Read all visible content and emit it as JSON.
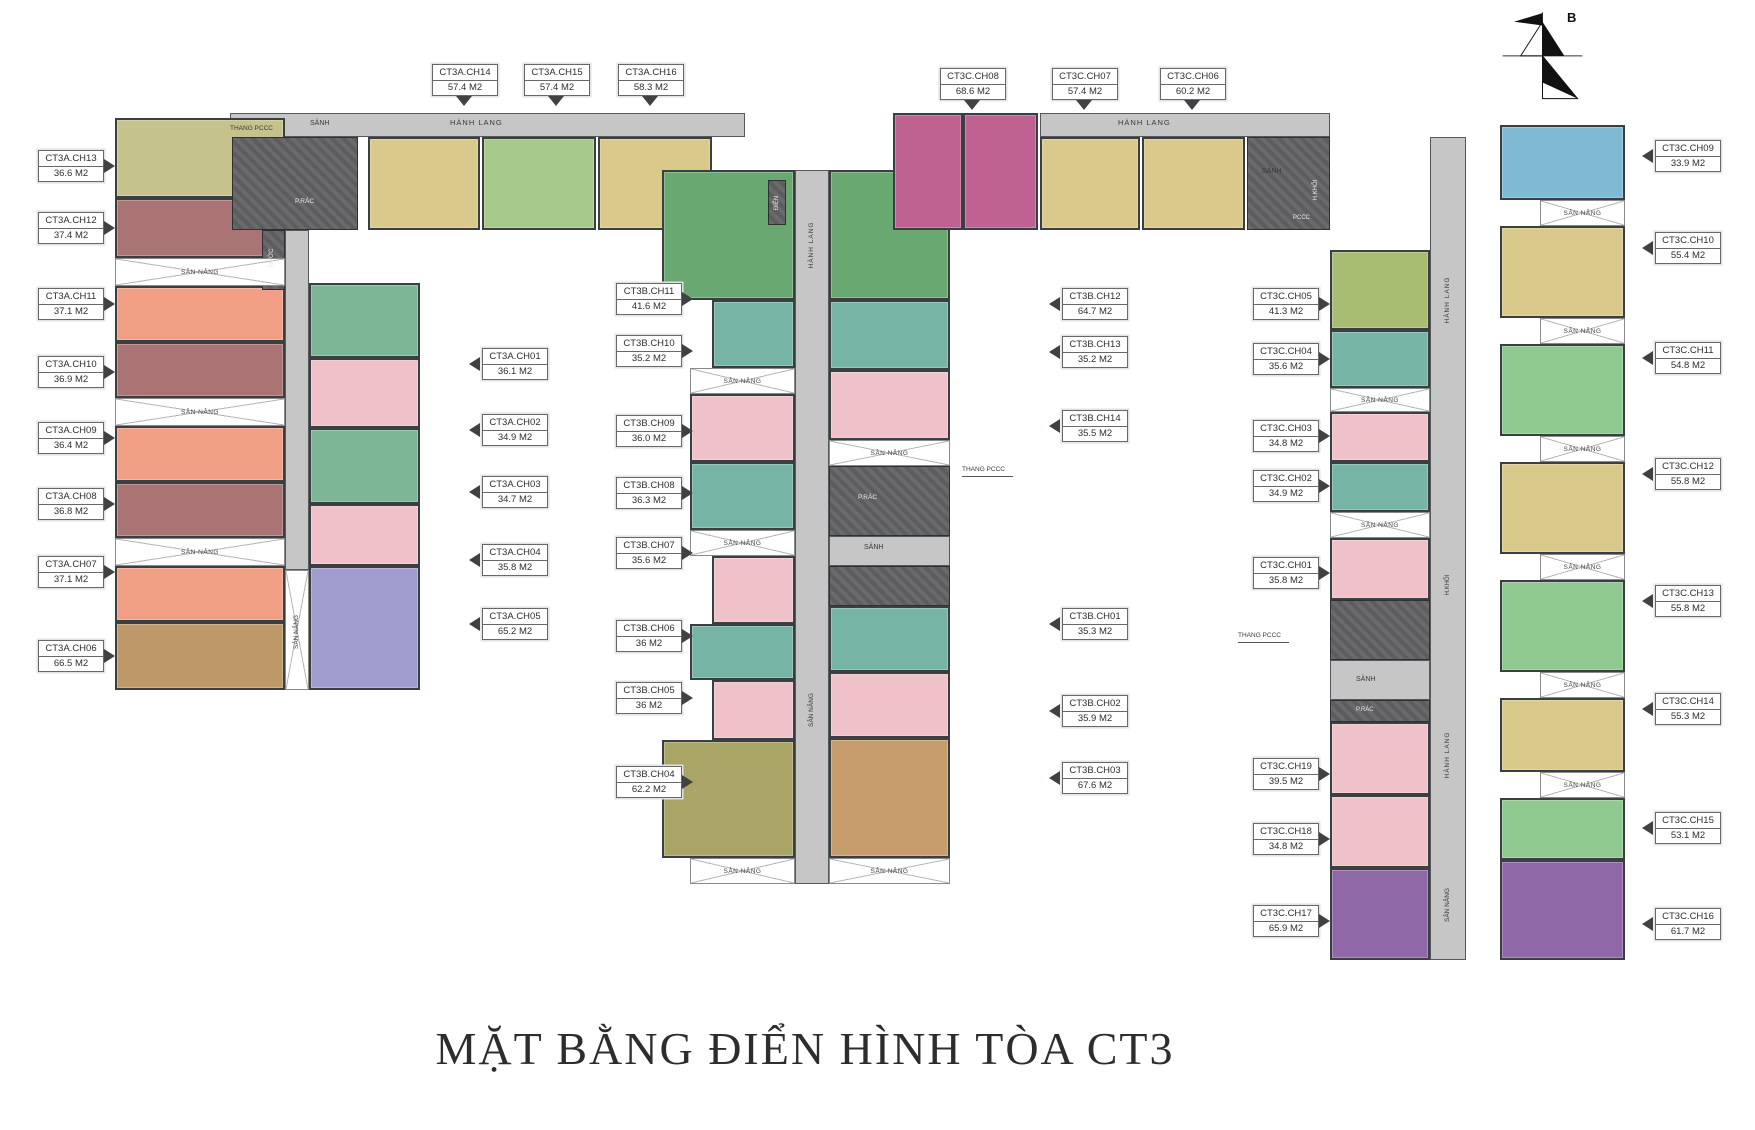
{
  "title": "MẶT BẰNG ĐIỂN HÌNH TÒA CT3",
  "compass_label": "B",
  "sn_label": "SÂN NÂNG",
  "units": [
    {
      "name": "CT3A.CH13",
      "area": "36.6 M2",
      "label": {
        "x": 38,
        "y": 150,
        "arrow": "right"
      },
      "block": {
        "x": 115,
        "y": 118,
        "w": 170,
        "h": 80,
        "color": "#c6c28b"
      }
    },
    {
      "name": "CT3A.CH12",
      "area": "37.4 M2",
      "label": {
        "x": 38,
        "y": 212,
        "arrow": "right"
      },
      "block": {
        "x": 115,
        "y": 198,
        "w": 170,
        "h": 60,
        "color": "#aa7474"
      }
    },
    {
      "name": "CT3A.CH11",
      "area": "37.1 M2",
      "label": {
        "x": 38,
        "y": 288,
        "arrow": "right"
      },
      "block": {
        "x": 115,
        "y": 286,
        "w": 170,
        "h": 56,
        "color": "#f19f85"
      }
    },
    {
      "name": "CT3A.CH10",
      "area": "36.9 M2",
      "label": {
        "x": 38,
        "y": 356,
        "arrow": "right"
      },
      "block": {
        "x": 115,
        "y": 342,
        "w": 170,
        "h": 56,
        "color": "#aa7474"
      }
    },
    {
      "name": "CT3A.CH09",
      "area": "36.4 M2",
      "label": {
        "x": 38,
        "y": 422,
        "arrow": "right"
      },
      "block": {
        "x": 115,
        "y": 426,
        "w": 170,
        "h": 56,
        "color": "#f19f85"
      }
    },
    {
      "name": "CT3A.CH08",
      "area": "36.8 M2",
      "label": {
        "x": 38,
        "y": 488,
        "arrow": "right"
      },
      "block": {
        "x": 115,
        "y": 482,
        "w": 170,
        "h": 56,
        "color": "#aa7474"
      }
    },
    {
      "name": "CT3A.CH07",
      "area": "37.1 M2",
      "label": {
        "x": 38,
        "y": 556,
        "arrow": "right"
      },
      "block": {
        "x": 115,
        "y": 566,
        "w": 170,
        "h": 56,
        "color": "#f19f85"
      }
    },
    {
      "name": "CT3A.CH06",
      "area": "66.5 M2",
      "label": {
        "x": 38,
        "y": 640,
        "arrow": "right"
      },
      "block": {
        "x": 115,
        "y": 622,
        "w": 170,
        "h": 68,
        "color": "#bf9869"
      }
    },
    {
      "name": "CT3A.CH14",
      "area": "57.4 M2",
      "label": {
        "x": 432,
        "y": 64,
        "arrow": "down"
      },
      "block": {
        "x": 368,
        "y": 137,
        "w": 112,
        "h": 93,
        "color": "#d9c98b"
      }
    },
    {
      "name": "CT3A.CH15",
      "area": "57.4 M2",
      "label": {
        "x": 524,
        "y": 64,
        "arrow": "down"
      },
      "block": {
        "x": 482,
        "y": 137,
        "w": 114,
        "h": 93,
        "color": "#a6c98c"
      }
    },
    {
      "name": "CT3A.CH16",
      "area": "58.3 M2",
      "label": {
        "x": 618,
        "y": 64,
        "arrow": "down"
      },
      "block": {
        "x": 598,
        "y": 137,
        "w": 114,
        "h": 93,
        "color": "#d9c98b"
      }
    },
    {
      "name": "CT3A.CH01",
      "area": "36.1 M2",
      "label": {
        "x": 482,
        "y": 348,
        "arrow": "left"
      },
      "block": {
        "x": 309,
        "y": 283,
        "w": 111,
        "h": 75,
        "color": "#7db696"
      }
    },
    {
      "name": "CT3A.CH02",
      "area": "34.9 M2",
      "label": {
        "x": 482,
        "y": 414,
        "arrow": "left"
      },
      "block": {
        "x": 309,
        "y": 358,
        "w": 111,
        "h": 70,
        "color": "#eec2c8"
      }
    },
    {
      "name": "CT3A.CH03",
      "area": "34.7 M2",
      "label": {
        "x": 482,
        "y": 476,
        "arrow": "left"
      },
      "block": {
        "x": 309,
        "y": 428,
        "w": 111,
        "h": 76,
        "color": "#7db696"
      }
    },
    {
      "name": "CT3A.CH04",
      "area": "35.8 M2",
      "label": {
        "x": 482,
        "y": 544,
        "arrow": "left"
      },
      "block": {
        "x": 309,
        "y": 504,
        "w": 111,
        "h": 62,
        "color": "#eec2c8"
      }
    },
    {
      "name": "CT3A.CH05",
      "area": "65.2 M2",
      "label": {
        "x": 482,
        "y": 608,
        "arrow": "left"
      },
      "block": {
        "x": 309,
        "y": 566,
        "w": 111,
        "h": 124,
        "color": "#a29dcf"
      }
    },
    {
      "name": "CT3B.CH11",
      "area": "41.6 M2",
      "label": {
        "x": 616,
        "y": 283,
        "arrow": "right"
      },
      "block": {
        "x": 662,
        "y": 170,
        "w": 133,
        "h": 130,
        "color": "#69a870"
      }
    },
    {
      "name": "CT3B.CH10",
      "area": "35.2 M2",
      "label": {
        "x": 616,
        "y": 335,
        "arrow": "right"
      },
      "block": {
        "x": 712,
        "y": 300,
        "w": 83,
        "h": 68,
        "color": "#76b5a5"
      }
    },
    {
      "name": "CT3B.CH09",
      "area": "36.0 M2",
      "label": {
        "x": 616,
        "y": 415,
        "arrow": "right"
      },
      "block": {
        "x": 690,
        "y": 394,
        "w": 105,
        "h": 68,
        "color": "#eec2c8"
      }
    },
    {
      "name": "CT3B.CH08",
      "area": "36.3 M2",
      "label": {
        "x": 616,
        "y": 477,
        "arrow": "right"
      },
      "block": {
        "x": 690,
        "y": 462,
        "w": 105,
        "h": 68,
        "color": "#76b5a5"
      }
    },
    {
      "name": "CT3B.CH07",
      "area": "35.6 M2",
      "label": {
        "x": 616,
        "y": 537,
        "arrow": "right"
      },
      "block": {
        "x": 712,
        "y": 556,
        "w": 83,
        "h": 68,
        "color": "#eec2c8"
      }
    },
    {
      "name": "CT3B.CH06",
      "area": "36 M2",
      "label": {
        "x": 616,
        "y": 620,
        "arrow": "right"
      },
      "block": {
        "x": 690,
        "y": 624,
        "w": 105,
        "h": 56,
        "color": "#76b5a5"
      }
    },
    {
      "name": "CT3B.CH05",
      "area": "36 M2",
      "label": {
        "x": 616,
        "y": 682,
        "arrow": "right"
      },
      "block": {
        "x": 712,
        "y": 680,
        "w": 83,
        "h": 60,
        "color": "#eec2c8"
      }
    },
    {
      "name": "CT3B.CH04",
      "area": "62.2 M2",
      "label": {
        "x": 616,
        "y": 766,
        "arrow": "right"
      },
      "block": {
        "x": 662,
        "y": 740,
        "w": 133,
        "h": 118,
        "color": "#a9a566"
      }
    },
    {
      "name": "CT3B.CH12",
      "area": "64.7 M2",
      "label": {
        "x": 1062,
        "y": 288,
        "arrow": "left"
      },
      "block": {
        "x": 893,
        "y": 113,
        "w": 70,
        "h": 117,
        "color": "#bf6191"
      }
    },
    {
      "name": "CT3B.CH13",
      "area": "35.2 M2",
      "label": {
        "x": 1062,
        "y": 336,
        "arrow": "left"
      },
      "block": {
        "x": 829,
        "y": 300,
        "w": 121,
        "h": 70,
        "color": "#76b5a5"
      }
    },
    {
      "name": "CT3B.CH14",
      "area": "35.5 M2",
      "label": {
        "x": 1062,
        "y": 410,
        "arrow": "left"
      },
      "block": {
        "x": 829,
        "y": 370,
        "w": 121,
        "h": 70,
        "color": "#eec2c8"
      }
    },
    {
      "name": "CT3B.CH01",
      "area": "35.3 M2",
      "label": {
        "x": 1062,
        "y": 608,
        "arrow": "left"
      },
      "block": {
        "x": 829,
        "y": 606,
        "w": 121,
        "h": 66,
        "color": "#76b5a5"
      }
    },
    {
      "name": "CT3B.CH02",
      "area": "35.9 M2",
      "label": {
        "x": 1062,
        "y": 695,
        "arrow": "left"
      },
      "block": {
        "x": 829,
        "y": 672,
        "w": 121,
        "h": 66,
        "color": "#eec2c8"
      }
    },
    {
      "name": "CT3B.CH03",
      "area": "67.6 M2",
      "label": {
        "x": 1062,
        "y": 762,
        "arrow": "left"
      },
      "block": {
        "x": 829,
        "y": 738,
        "w": 121,
        "h": 120,
        "color": "#c79d6e"
      }
    },
    {
      "name": "CT3C.CH08",
      "area": "68.6 M2",
      "label": {
        "x": 940,
        "y": 68,
        "arrow": "down"
      },
      "block": {
        "x": 963,
        "y": 113,
        "w": 75,
        "h": 117,
        "color": "#bf6191"
      }
    },
    {
      "name": "CT3C.CH07",
      "area": "57.4 M2",
      "label": {
        "x": 1052,
        "y": 68,
        "arrow": "down"
      },
      "block": {
        "x": 1040,
        "y": 137,
        "w": 100,
        "h": 93,
        "color": "#d9c98b"
      }
    },
    {
      "name": "CT3C.CH06",
      "area": "60.2 M2",
      "label": {
        "x": 1160,
        "y": 68,
        "arrow": "down"
      },
      "block": {
        "x": 1142,
        "y": 137,
        "w": 103,
        "h": 93,
        "color": "#d9c98b"
      }
    },
    {
      "name": "CT3C.CH05",
      "area": "41.3 M2",
      "label": {
        "x": 1253,
        "y": 288,
        "arrow": "right"
      },
      "block": {
        "x": 1330,
        "y": 250,
        "w": 100,
        "h": 80,
        "color": "#a8bc72"
      }
    },
    {
      "name": "CT3C.CH04",
      "area": "35.6 M2",
      "label": {
        "x": 1253,
        "y": 343,
        "arrow": "right"
      },
      "block": {
        "x": 1330,
        "y": 330,
        "w": 100,
        "h": 58,
        "color": "#76b5a5"
      }
    },
    {
      "name": "CT3C.CH03",
      "area": "34.8 M2",
      "label": {
        "x": 1253,
        "y": 420,
        "arrow": "right"
      },
      "block": {
        "x": 1330,
        "y": 412,
        "w": 100,
        "h": 50,
        "color": "#eec2c8"
      }
    },
    {
      "name": "CT3C.CH02",
      "area": "34.9 M2",
      "label": {
        "x": 1253,
        "y": 470,
        "arrow": "right"
      },
      "block": {
        "x": 1330,
        "y": 462,
        "w": 100,
        "h": 50,
        "color": "#76b5a5"
      }
    },
    {
      "name": "CT3C.CH01",
      "area": "35.8 M2",
      "label": {
        "x": 1253,
        "y": 557,
        "arrow": "right"
      },
      "block": {
        "x": 1330,
        "y": 538,
        "w": 100,
        "h": 62,
        "color": "#eec2c8"
      }
    },
    {
      "name": "CT3C.CH19",
      "area": "39.5 M2",
      "label": {
        "x": 1253,
        "y": 758,
        "arrow": "right"
      },
      "block": {
        "x": 1330,
        "y": 722,
        "w": 100,
        "h": 73,
        "color": "#eec2c8"
      }
    },
    {
      "name": "CT3C.CH18",
      "area": "34.8 M2",
      "label": {
        "x": 1253,
        "y": 823,
        "arrow": "right"
      },
      "block": {
        "x": 1330,
        "y": 795,
        "w": 100,
        "h": 73,
        "color": "#eec2c8"
      }
    },
    {
      "name": "CT3C.CH17",
      "area": "65.9 M2",
      "label": {
        "x": 1253,
        "y": 905,
        "arrow": "right"
      },
      "block": {
        "x": 1330,
        "y": 868,
        "w": 100,
        "h": 92,
        "color": "#8f68a8"
      }
    },
    {
      "name": "CT3C.CH09",
      "area": "33.9 M2",
      "label": {
        "x": 1655,
        "y": 140,
        "arrow": "left"
      },
      "block": {
        "x": 1500,
        "y": 125,
        "w": 125,
        "h": 75,
        "color": "#7fb9d4"
      }
    },
    {
      "name": "CT3C.CH10",
      "area": "55.4 M2",
      "label": {
        "x": 1655,
        "y": 232,
        "arrow": "left"
      },
      "block": {
        "x": 1500,
        "y": 226,
        "w": 125,
        "h": 92,
        "color": "#d9c98b"
      }
    },
    {
      "name": "CT3C.CH11",
      "area": "54.8 M2",
      "label": {
        "x": 1655,
        "y": 342,
        "arrow": "left"
      },
      "block": {
        "x": 1500,
        "y": 344,
        "w": 125,
        "h": 92,
        "color": "#8fc990"
      }
    },
    {
      "name": "CT3C.CH12",
      "area": "55.8 M2",
      "label": {
        "x": 1655,
        "y": 458,
        "arrow": "left"
      },
      "block": {
        "x": 1500,
        "y": 462,
        "w": 125,
        "h": 92,
        "color": "#d9c98b"
      }
    },
    {
      "name": "CT3C.CH13",
      "area": "55.8 M2",
      "label": {
        "x": 1655,
        "y": 585,
        "arrow": "left"
      },
      "block": {
        "x": 1500,
        "y": 580,
        "w": 125,
        "h": 92,
        "color": "#8fc990"
      }
    },
    {
      "name": "CT3C.CH14",
      "area": "55.3 M2",
      "label": {
        "x": 1655,
        "y": 693,
        "arrow": "left"
      },
      "block": {
        "x": 1500,
        "y": 698,
        "w": 125,
        "h": 74,
        "color": "#d9c98b"
      }
    },
    {
      "name": "CT3C.CH15",
      "area": "53.1 M2",
      "label": {
        "x": 1655,
        "y": 812,
        "arrow": "left"
      },
      "block": {
        "x": 1500,
        "y": 798,
        "w": 125,
        "h": 62,
        "color": "#8fc990"
      }
    },
    {
      "name": "CT3C.CH16",
      "area": "61.7 M2",
      "label": {
        "x": 1655,
        "y": 908,
        "arrow": "left"
      },
      "block": {
        "x": 1500,
        "y": 860,
        "w": 125,
        "h": 100,
        "color": "#8f68a8"
      }
    }
  ],
  "extra_blocks": [
    {
      "x": 829,
      "y": 170,
      "w": 121,
      "h": 130,
      "color": "#69a870"
    }
  ],
  "corridors": [
    {
      "x": 230,
      "y": 113,
      "w": 515,
      "h": 24
    },
    {
      "x": 285,
      "y": 230,
      "w": 24,
      "h": 340
    },
    {
      "x": 795,
      "y": 170,
      "w": 34,
      "h": 714
    },
    {
      "x": 1040,
      "y": 113,
      "w": 290,
      "h": 24
    },
    {
      "x": 1430,
      "y": 137,
      "w": 36,
      "h": 823
    },
    {
      "x": 829,
      "y": 536,
      "w": 121,
      "h": 30
    },
    {
      "x": 1330,
      "y": 660,
      "w": 100,
      "h": 40
    },
    {
      "x": 1247,
      "y": 163,
      "w": 83,
      "h": 26
    }
  ],
  "cores": [
    {
      "x": 232,
      "y": 137,
      "w": 126,
      "h": 93
    },
    {
      "x": 262,
      "y": 230,
      "w": 23,
      "h": 60
    },
    {
      "x": 768,
      "y": 180,
      "w": 18,
      "h": 45
    },
    {
      "x": 829,
      "y": 466,
      "w": 121,
      "h": 70
    },
    {
      "x": 829,
      "y": 566,
      "w": 121,
      "h": 40
    },
    {
      "x": 1247,
      "y": 137,
      "w": 83,
      "h": 93
    },
    {
      "x": 1330,
      "y": 600,
      "w": 100,
      "h": 60
    },
    {
      "x": 1330,
      "y": 700,
      "w": 100,
      "h": 22
    }
  ],
  "sn_strips": [
    {
      "x": 115,
      "y": 258,
      "w": 170,
      "h": 28
    },
    {
      "x": 115,
      "y": 398,
      "w": 170,
      "h": 28
    },
    {
      "x": 115,
      "y": 538,
      "w": 170,
      "h": 28
    },
    {
      "x": 285,
      "y": 570,
      "w": 24,
      "h": 120
    },
    {
      "x": 690,
      "y": 368,
      "w": 105,
      "h": 26
    },
    {
      "x": 690,
      "y": 530,
      "w": 105,
      "h": 26
    },
    {
      "x": 690,
      "y": 858,
      "w": 105,
      "h": 26
    },
    {
      "x": 829,
      "y": 440,
      "w": 121,
      "h": 26
    },
    {
      "x": 829,
      "y": 858,
      "w": 121,
      "h": 26
    },
    {
      "x": 1330,
      "y": 388,
      "w": 100,
      "h": 24
    },
    {
      "x": 1330,
      "y": 512,
      "w": 100,
      "h": 26
    },
    {
      "x": 1540,
      "y": 200,
      "w": 85,
      "h": 26
    },
    {
      "x": 1540,
      "y": 318,
      "w": 85,
      "h": 26
    },
    {
      "x": 1540,
      "y": 436,
      "w": 85,
      "h": 26
    },
    {
      "x": 1540,
      "y": 554,
      "w": 85,
      "h": 26
    },
    {
      "x": 1540,
      "y": 672,
      "w": 85,
      "h": 26
    },
    {
      "x": 1540,
      "y": 772,
      "w": 85,
      "h": 26
    }
  ],
  "plan_texts": [
    {
      "t": "THANG PCCC",
      "x": 230,
      "y": 123,
      "fs": 6.5
    },
    {
      "t": "SẢNH",
      "x": 310,
      "y": 118,
      "fs": 7
    },
    {
      "t": "HÀNH LANG",
      "x": 450,
      "y": 117,
      "fs": 7.5
    },
    {
      "t": "P.RÁC",
      "x": 295,
      "y": 196,
      "fs": 6.5,
      "c": "#eaeaea"
    },
    {
      "t": "NƯỚC",
      "x": 272,
      "y": 258,
      "fs": 6,
      "c": "#eaeaea",
      "rot": 1
    },
    {
      "t": "SÂN NÂNG",
      "x": 297,
      "y": 632,
      "fs": 6.5,
      "rot": 1
    },
    {
      "t": "ĐIỆN",
      "x": 777,
      "y": 203,
      "fs": 6,
      "c": "#eaeaea",
      "rot": 1
    },
    {
      "t": "HÀNH LANG",
      "x": 812,
      "y": 245,
      "fs": 6.5,
      "rot": 1
    },
    {
      "t": "SÂN NÂNG",
      "x": 812,
      "y": 710,
      "fs": 6.5,
      "rot": 1
    },
    {
      "t": "P.RÁC",
      "x": 858,
      "y": 492,
      "fs": 6.5,
      "c": "#eaeaea"
    },
    {
      "t": "SẢNH",
      "x": 864,
      "y": 542,
      "fs": 7
    },
    {
      "t": "THANG PCCC",
      "x": 962,
      "y": 464,
      "fs": 6.5,
      "line": 1
    },
    {
      "t": "HÀNH LANG",
      "x": 1118,
      "y": 117,
      "fs": 7.5
    },
    {
      "t": "SẢNH",
      "x": 1262,
      "y": 166,
      "fs": 7
    },
    {
      "t": "PCCC",
      "x": 1293,
      "y": 212,
      "fs": 6,
      "c": "#eaeaea"
    },
    {
      "t": "H.KHỐI",
      "x": 1316,
      "y": 190,
      "fs": 6,
      "c": "#eaeaea",
      "rot": 1
    },
    {
      "t": "HÀNH LANG",
      "x": 1448,
      "y": 300,
      "fs": 6.5,
      "rot": 1
    },
    {
      "t": "H.KHỐI",
      "x": 1448,
      "y": 585,
      "fs": 6,
      "rot": 1
    },
    {
      "t": "HÀNH LANG",
      "x": 1448,
      "y": 755,
      "fs": 6.5,
      "rot": 1
    },
    {
      "t": "SÂN NÂNG",
      "x": 1448,
      "y": 905,
      "fs": 6.5,
      "rot": 1
    },
    {
      "t": "THANG PCCC",
      "x": 1238,
      "y": 630,
      "fs": 6.5,
      "line": 1
    },
    {
      "t": "SẢNH",
      "x": 1356,
      "y": 674,
      "fs": 7
    },
    {
      "t": "P.RÁC",
      "x": 1356,
      "y": 704,
      "fs": 6,
      "c": "#eaeaea"
    }
  ]
}
